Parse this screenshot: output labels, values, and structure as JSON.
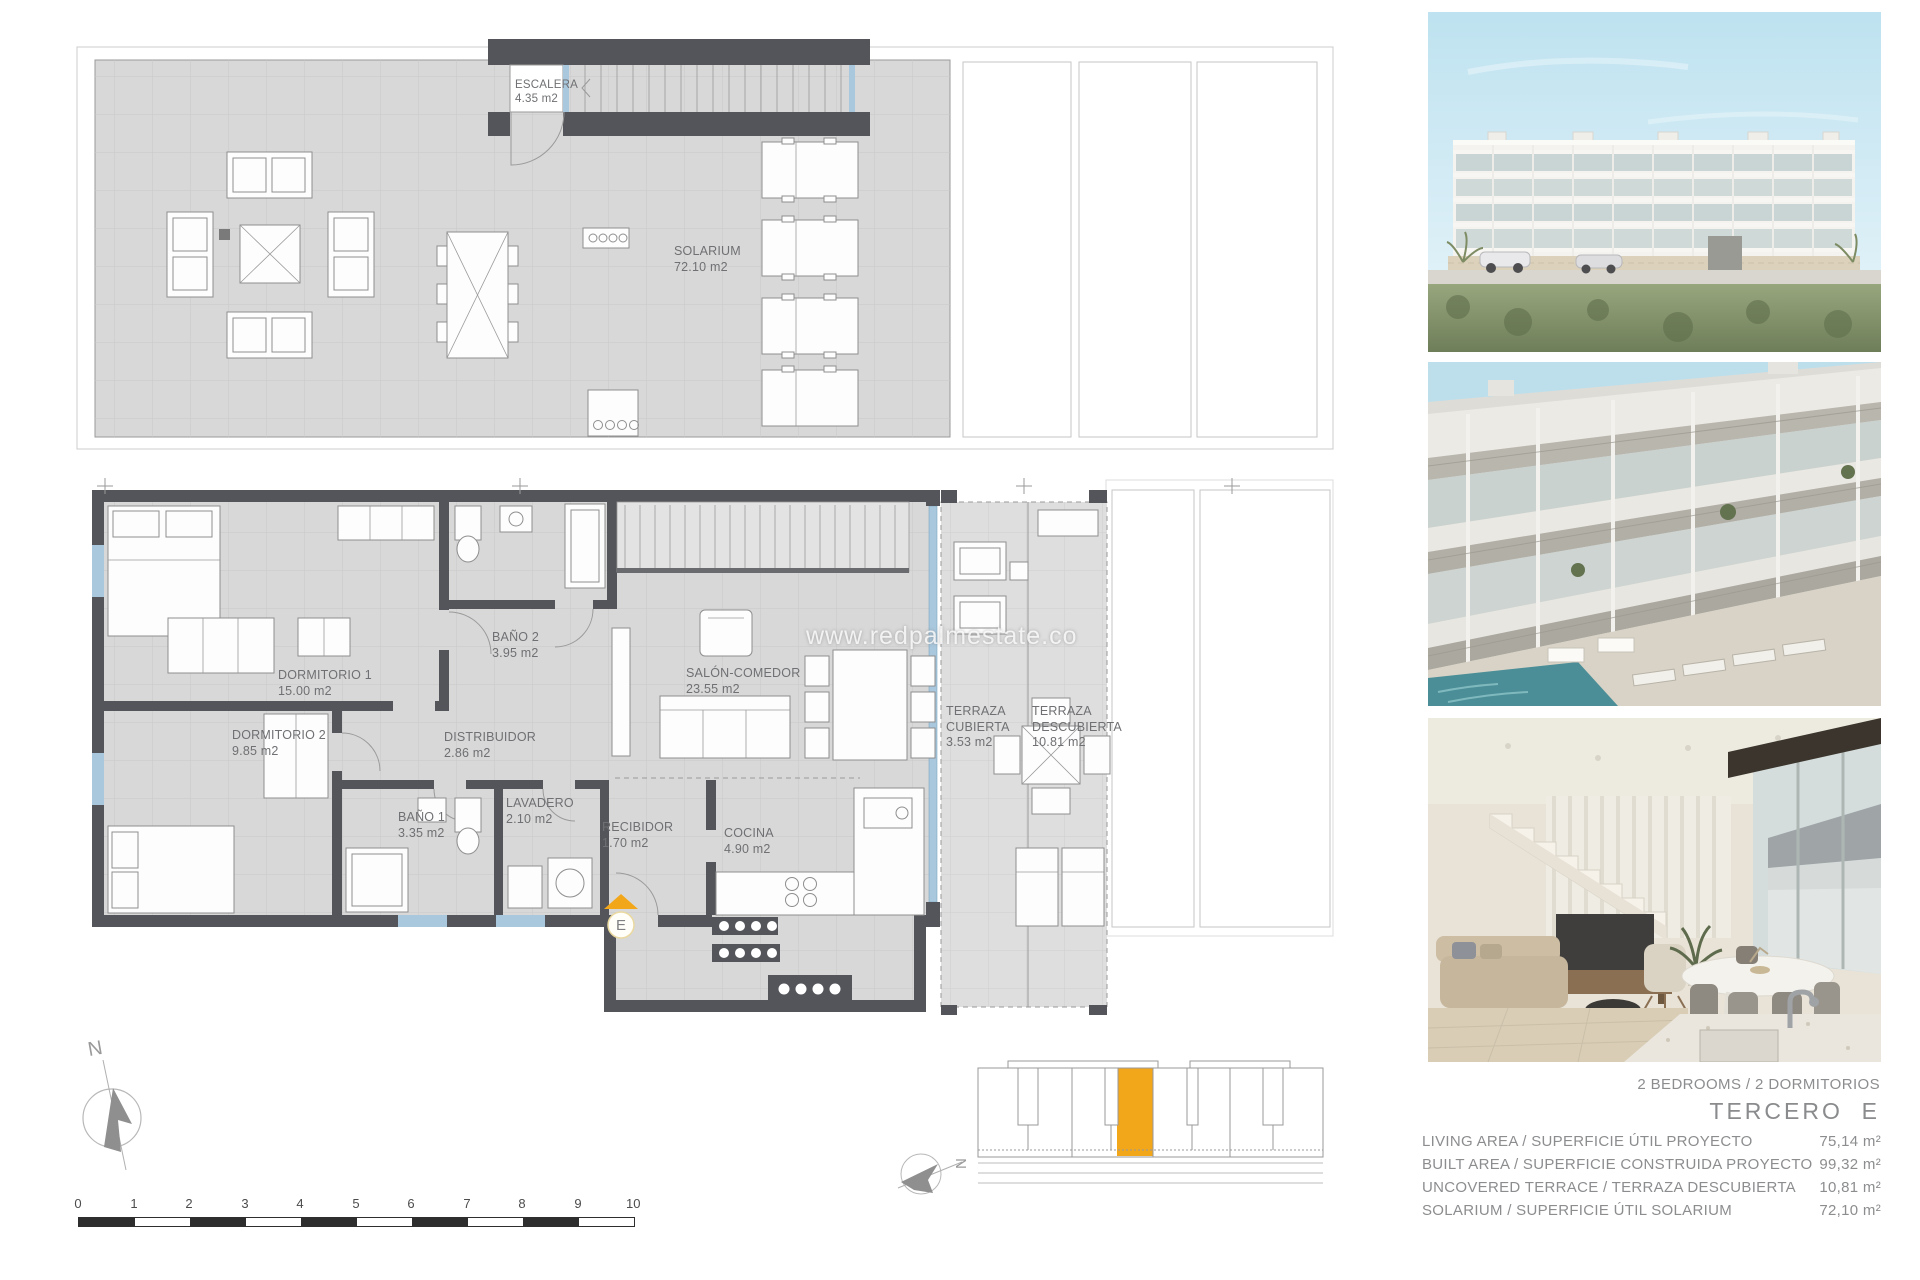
{
  "page": {
    "watermark": "www.redpalmestate.co"
  },
  "solarium_plan": {
    "stair_label": "ESCALERA",
    "stair_area": "4.35 m2",
    "name": "SOLARIUM",
    "area": "72.10 m2"
  },
  "floor_plan": {
    "rooms": [
      {
        "label": "DORMITORIO 1",
        "area": "15.00 m2"
      },
      {
        "label": "BAÑO 2",
        "area": "3.95 m2"
      },
      {
        "label": "DORMITORIO 2",
        "area": "9.85 m2"
      },
      {
        "label": "DISTRIBUIDOR",
        "area": "2.86 m2"
      },
      {
        "label": "BAÑO 1",
        "area": "3.35 m2"
      },
      {
        "label": "LAVADERO",
        "area": "2.10 m2"
      },
      {
        "label": "RECIBIDOR",
        "area": "1.70 m2"
      },
      {
        "label": "COCINA",
        "area": "4.90 m2"
      },
      {
        "label": "SALÓN-COMEDOR",
        "area": "23.55 m2"
      },
      {
        "label": "TERRAZA CUBIERTA",
        "area": "3.53 m2"
      },
      {
        "label": "TERRAZA DESCUBIERTA",
        "area": "10.81 m2"
      }
    ],
    "entrance_label": "E"
  },
  "compass": {
    "north": "N"
  },
  "key_plan": {
    "north": "N",
    "highlight_color": "#F2A71B"
  },
  "scale_bar": {
    "ticks": [
      "0",
      "1",
      "2",
      "3",
      "4",
      "5",
      "6",
      "7",
      "8",
      "9",
      "10"
    ]
  },
  "summary": {
    "bedrooms": "2 BEDROOMS / 2 DORMITORIOS",
    "title": "TERCERO  E",
    "rows": [
      {
        "label": "LIVING AREA / SUPERFICIE ÚTIL PROYECTO",
        "value": "75,14 m²"
      },
      {
        "label": "BUILT AREA / SUPERFICIE CONSTRUIDA PROYECTO",
        "value": "99,32 m²"
      },
      {
        "label": "UNCOVERED TERRACE / TERRAZA DESCUBIERTA",
        "value": "10,81 m²"
      },
      {
        "label": "SOLARIUM / SUPERFICIE ÚTIL SOLARIUM",
        "value": "72,10 m²"
      }
    ]
  },
  "photos": [
    {
      "name": "building-exterior-front"
    },
    {
      "name": "building-terraces-pool"
    },
    {
      "name": "interior-living-room"
    }
  ],
  "colors": {
    "accent": "#F2A71B",
    "wall": "#54555A",
    "floor": "#D8D8D8",
    "glass": "#A9C7DD"
  }
}
